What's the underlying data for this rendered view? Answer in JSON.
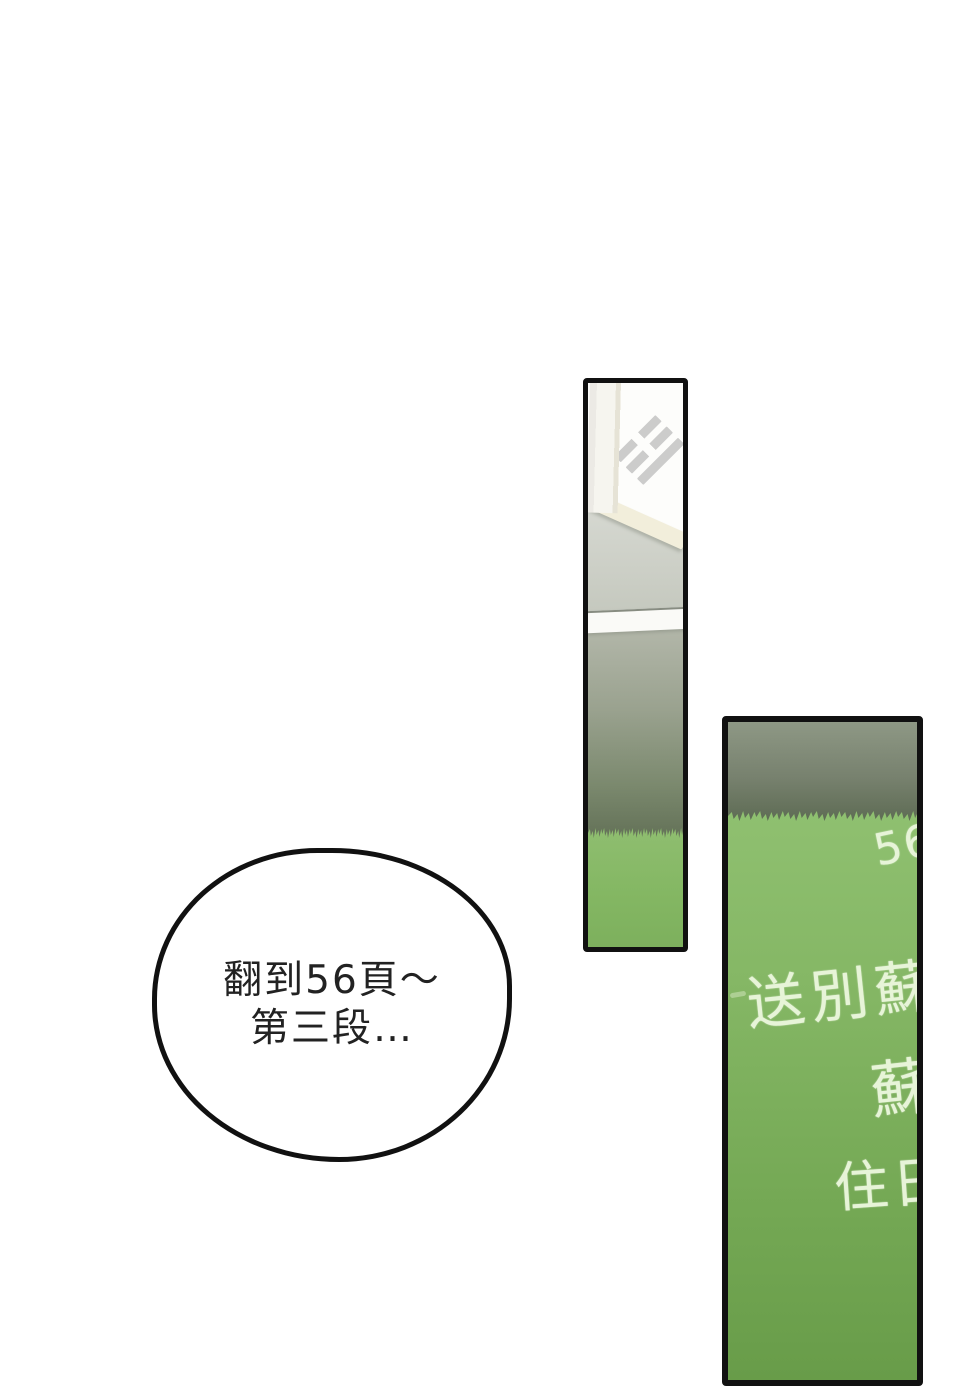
{
  "page": {
    "background_color": "#ffffff"
  },
  "panels": {
    "window_panel": {
      "flag_icon": "taegukgi-trigram",
      "colors": {
        "glass": "#fdfdfb",
        "frame_cream": "#f2eedb",
        "wall_gray": "#d2d5cd",
        "ledge_white": "#fafaf7",
        "shade_dark": "#637157",
        "grass_green": "#8bb96d",
        "trigram_gray": "#c0c0c0",
        "border": "#111111"
      }
    },
    "chalkboard_panel": {
      "page_number": "56",
      "chalk_lines": [
        "送別蘇",
        "蘇",
        "住日"
      ],
      "colors": {
        "board_green_top": "#8fc070",
        "board_green_bottom": "#689c49",
        "shadow_top": "#8e9885",
        "chalk": "#e7f4d8",
        "border": "#111111"
      }
    }
  },
  "speech_bubble": {
    "lines": [
      "翻到56頁～",
      "第三段…"
    ],
    "text_color": "#222222",
    "fill": "#ffffff",
    "border": "#111111"
  }
}
